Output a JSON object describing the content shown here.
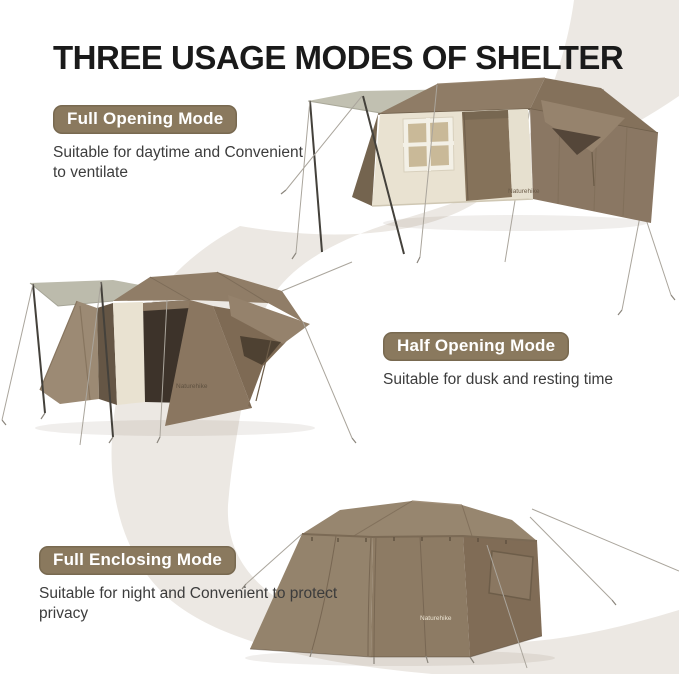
{
  "header": {
    "title": "THREE USAGE MODES OF SHELTER"
  },
  "brand": {
    "logo_text": "Naturehike"
  },
  "sections": [
    {
      "id": "full-opening",
      "badge": "Full Opening Mode",
      "description": "Suitable for daytime and Convenient to ventilate"
    },
    {
      "id": "half-opening",
      "badge": "Half Opening Mode",
      "description": "Suitable for dusk and resting time"
    },
    {
      "id": "full-enclosing",
      "badge": "Full Enclosing Mode",
      "description": "Suitable for night and Convenient to protect privacy"
    }
  ],
  "colors": {
    "background": "#ffffff",
    "ribbon": "#ece8e3",
    "badge_background": "#8a795e",
    "badge_text": "#ffffff",
    "title_text": "#1a1a1a",
    "description_text": "#3c3c3c",
    "tent_canvas_brown": "#8d7a64",
    "tent_wall_cream": "#e9e2d1",
    "awning_gray": "#bfbeb0"
  }
}
